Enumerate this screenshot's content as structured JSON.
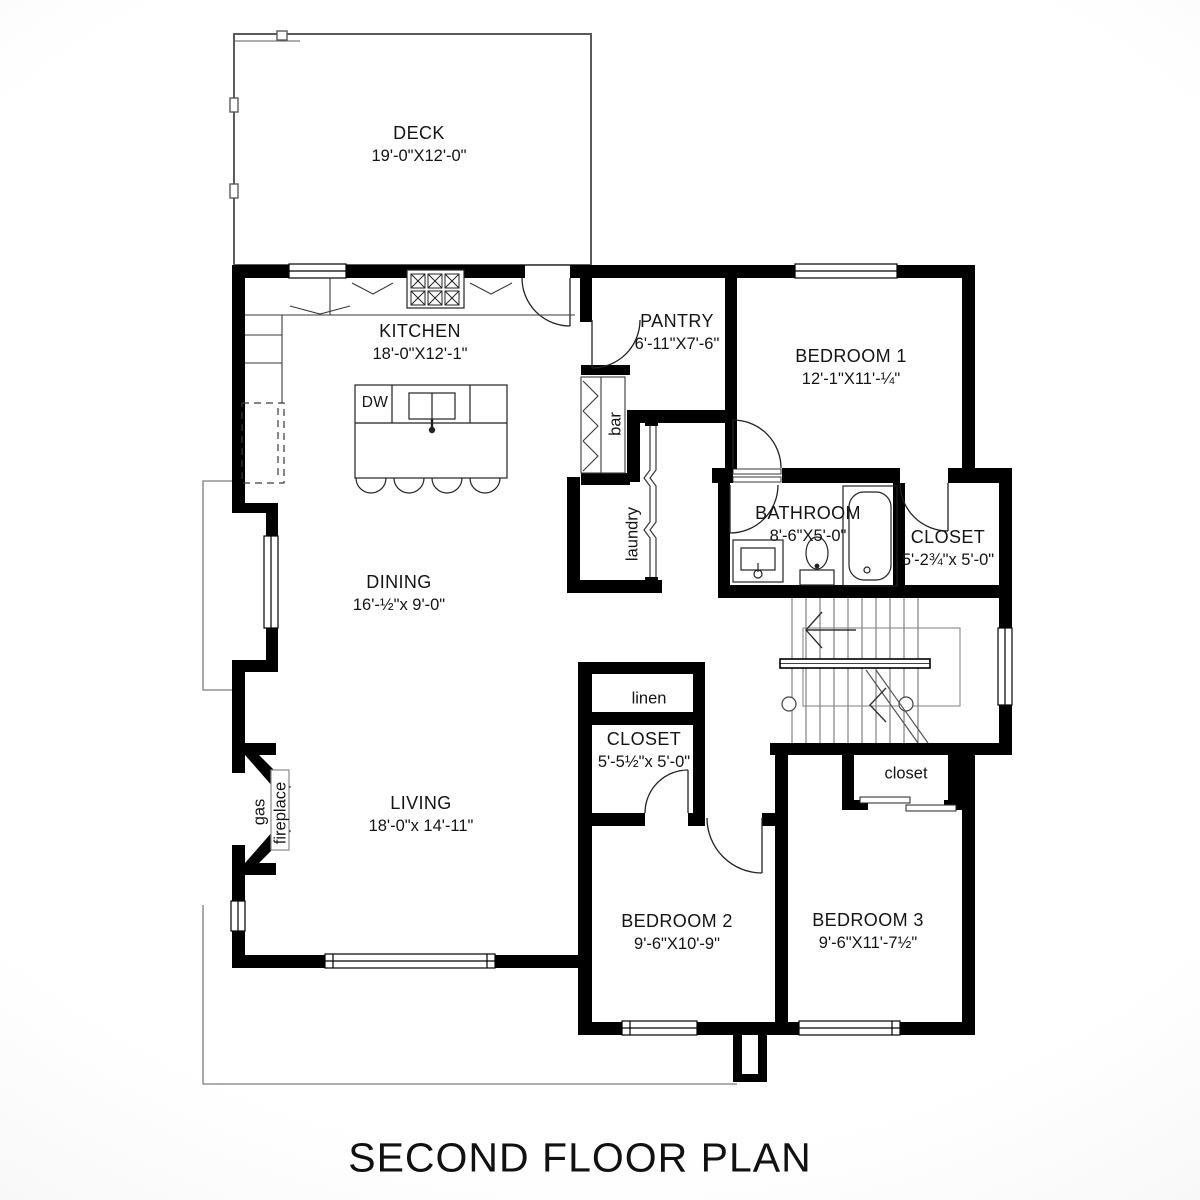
{
  "title": "SECOND FLOOR PLAN",
  "rooms": {
    "deck": {
      "name": "DECK",
      "dims": "19'-0\"X12'-0\""
    },
    "kitchen": {
      "name": "KITCHEN",
      "dims": "18'-0\"X12'-1\""
    },
    "pantry": {
      "name": "PANTRY",
      "dims": "6'-11\"X7'-6\""
    },
    "bedroom1": {
      "name": "BEDROOM 1",
      "dims": "12'-1\"X11'-¼\""
    },
    "bathroom": {
      "name": "BATHROOM",
      "dims": "8'-6\"X5'-0\""
    },
    "closet_bath": {
      "name": "CLOSET",
      "dims": "5'-2¾\"x 5'-0\""
    },
    "dining": {
      "name": "DINING",
      "dims": "16'-½\"x 9'-0\""
    },
    "living": {
      "name": "LIVING",
      "dims": "18'-0\"x 14'-11\""
    },
    "closet_hall": {
      "name": "CLOSET",
      "dims": "5'-5½\"x 5'-0\""
    },
    "bedroom2": {
      "name": "BEDROOM 2",
      "dims": "9'-6\"X10'-9\""
    },
    "bedroom3": {
      "name": "BEDROOM 3",
      "dims": "9'-6\"X11'-7½\""
    }
  },
  "features": {
    "bar": "bar",
    "laundry": "laundry",
    "linen": "linen",
    "closet_small": "closet",
    "gas": "gas",
    "fireplace": "fireplace",
    "dishwasher": "DW"
  },
  "colors": {
    "wall": "#000000",
    "thin_line": "#3a3a3a",
    "faint_line": "#8a8a8a",
    "paper": "#ffffff"
  }
}
